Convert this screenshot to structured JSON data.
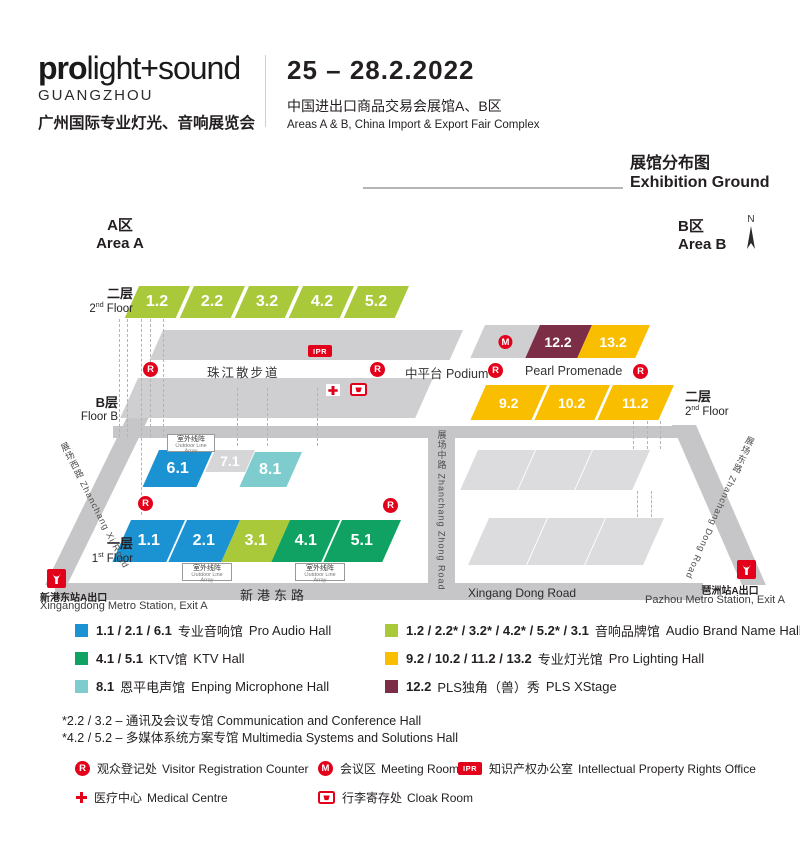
{
  "colors": {
    "red": "#e2001a",
    "blue": "#1b93d3",
    "yellow_green": "#a9c93b",
    "green": "#10a263",
    "teal": "#7ecccd",
    "yellow": "#f9be00",
    "maroon": "#7d2e47",
    "road_gray": "#c6c6c8",
    "building_gray": "#cfcfd1"
  },
  "header": {
    "logo_bold": "pro",
    "logo_light": "light+sound",
    "city": "GUANGZHOU",
    "title_cn": "广州国际专业灯光、音响展览会",
    "dates": "25 – 28.2.2022",
    "venue_cn": "中国进出口商品交易会展馆A、B区",
    "venue_en": "Areas A & B, China Import & Export Fair Complex"
  },
  "section_title": {
    "cn": "展馆分布图",
    "en": "Exhibition Ground"
  },
  "areas": {
    "a_cn": "A区",
    "a_en": "Area A",
    "b_cn": "B区",
    "b_en": "Area B",
    "north": "N"
  },
  "floors": {
    "f2": {
      "cn": "二层",
      "num": "2",
      "sup": "nd",
      "rest": " Floor"
    },
    "f1": {
      "cn": "一层",
      "num": "1",
      "sup": "st",
      "rest": " Floor"
    },
    "fb": {
      "cn": "B层",
      "en": "Floor B"
    }
  },
  "map": {
    "a2_halls": [
      "1.2",
      "2.2",
      "3.2",
      "4.2",
      "5.2"
    ],
    "b2_top": [
      "12.2",
      "13.2"
    ],
    "b2_bottom": [
      "9.2",
      "10.2",
      "11.2"
    ],
    "mid_halls": [
      "6.1",
      "7.1",
      "8.1"
    ],
    "a1_halls": [
      "1.1",
      "2.1",
      "3.1",
      "4.1",
      "5.1"
    ],
    "promenade": {
      "zhujiang": "珠江散步道",
      "podium": "中平台 Podium",
      "pearl": "Pearl Promenade"
    },
    "outdoor": {
      "cn": "室外线阵",
      "en": "Outdoor Line Array"
    },
    "markers": {
      "registration": "R",
      "meeting": "M",
      "ipr": "IPR"
    },
    "roads": {
      "west": "展场西路 Zhanchang Xi Road",
      "mid": "展场中路 Zhanchang Zhong Road",
      "east": "展场东路 Zhanchang Dong Road",
      "south_cn": "新港东路",
      "south_en": "Xingang Dong Road"
    },
    "metro_left": {
      "cn": "新港东站A出口",
      "en": "Xingangdong Metro Station, Exit A"
    },
    "metro_right": {
      "cn": "琶洲站A出口",
      "en": "Pazhou Metro Station, Exit A"
    }
  },
  "legend": {
    "items": [
      {
        "nums": "1.1 / 2.1 / 6.1",
        "cn": "专业音响馆",
        "en": "Pro Audio Hall"
      },
      {
        "nums": "1.2 / 2.2* / 3.2* / 4.2* / 5.2* / 3.1",
        "cn": "音响品牌馆",
        "en": "Audio Brand Name Hall"
      },
      {
        "nums": "4.1 / 5.1",
        "cn": "KTV馆",
        "en": "KTV Hall"
      },
      {
        "nums": "9.2 / 10.2 / 11.2 / 13.2",
        "cn": "专业灯光馆",
        "en": "Pro Lighting Hall"
      },
      {
        "nums": "8.1",
        "cn": "恩平电声馆",
        "en": "Enping Microphone Hall"
      },
      {
        "nums": "12.2",
        "cn": "PLS独角（兽）秀",
        "en": "PLS XStage"
      }
    ],
    "footnotes": [
      "*2.2 / 3.2 – 通讯及会议专馆 Communication and Conference Hall",
      "*4.2 / 5.2 – 多媒体系统方案专馆 Multimedia Systems and Solutions Hall"
    ],
    "facilities": [
      {
        "icon": "R",
        "cn": "观众登记处",
        "en": "Visitor Registration Counter"
      },
      {
        "icon": "M",
        "cn": "会议区",
        "en": "Meeting Room"
      },
      {
        "icon": "IPR",
        "cn": "知识产权办公室",
        "en": "Intellectual Property Rights Office"
      },
      {
        "icon": "cross",
        "cn": "医疗中心",
        "en": "Medical Centre"
      },
      {
        "icon": "cloak",
        "cn": "行李寄存处",
        "en": "Cloak Room"
      }
    ]
  }
}
